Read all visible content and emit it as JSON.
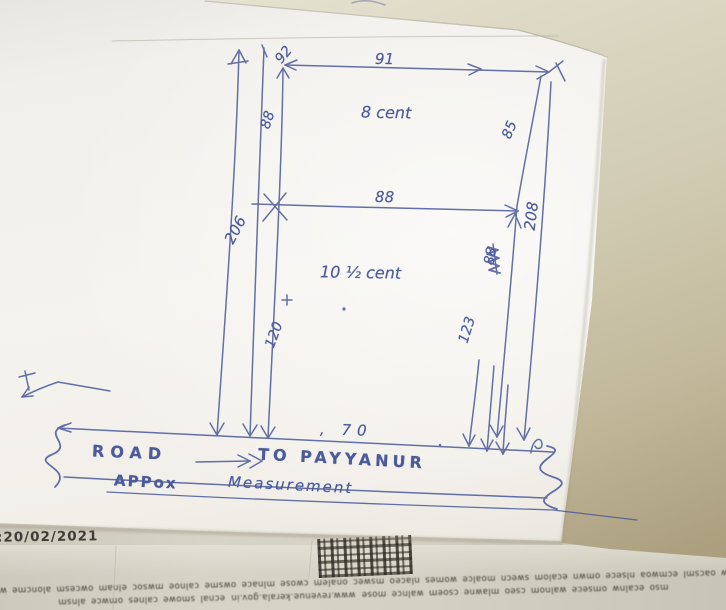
{
  "photo": {
    "description": "hand-drawn land plot sketch on white paper over a printed Kerala revenue document",
    "ink_color": "#4d5c9b"
  },
  "sketch": {
    "labels": {
      "offset_92": "92",
      "top_width_91": "91",
      "upper_left_88": "88",
      "upper_area": "8 cent",
      "upper_right_85": "85",
      "left_total_206": "206",
      "mid_width_88": "88",
      "right_total_208": "208",
      "scribbled_88": "88",
      "lower_area": "10 ½ cent",
      "lower_left_120": "120",
      "lower_right_123": "123",
      "frontage_70": ", 70",
      "road": "ROAD",
      "to_payyanur": "TO PAYYANUR",
      "approx": "APPox",
      "measurement": "Measurement"
    }
  },
  "printed_strip": {
    "date": ":20/02/2021",
    "footer_line1": "emw oacsml ecmwoa nlsece omwn ecalom swecn moalce womes nlaceo mswec onalem cwose mlnace owsme calnoe mwsoc elnam owcesm aloncme wsoe",
    "footer_line2_left": "mso ecalnw omsece walnom cseo mlawne csoem walnce mose",
    "footer_url": "www.revenue.kerala.gov.in",
    "footer_line2_right": "ecnal smowe calnes omwce alnsm"
  }
}
